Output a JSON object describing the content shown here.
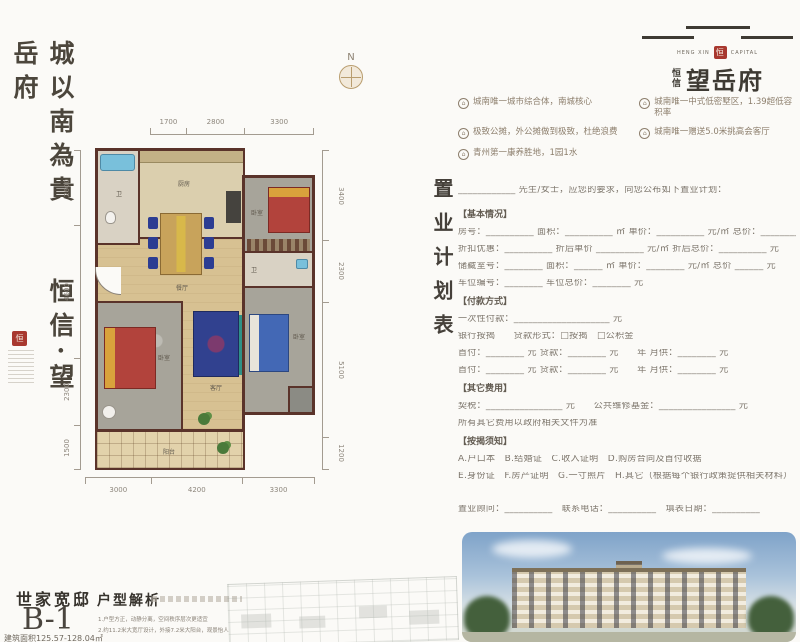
{
  "brand": {
    "calligraphy": "城以南為貴　　恒信·望岳府",
    "seal_char": "恒",
    "logo_en_left": "HENG XIN",
    "logo_en_right": "CAPITAL",
    "logo_small": "恒信",
    "logo_large": "望岳府"
  },
  "selling_points": [
    "城南唯一城市综合体，南城核心",
    "城南唯一中式低密墅区，1.39超低容积率",
    "极致公摊，外公摊做到极致，杜绝浪费",
    "城南唯一赠送5.0米挑高会客厅",
    "青州第一康养胜地，1园1水"
  ],
  "floorplan": {
    "compass_label": "N",
    "dims": {
      "top": [
        1700,
        2800,
        3300
      ],
      "left": [
        2600,
        4600,
        2300,
        1500
      ],
      "right": [
        3400,
        2300,
        5100,
        1200
      ],
      "bottom": [
        3000,
        4200,
        3300
      ]
    },
    "rooms": {
      "bath1": "卫",
      "kitchen": "厨房",
      "bedroom1": "卧室",
      "dining": "餐厅",
      "bath2": "卫",
      "living": "客厅",
      "bedroom2": "卧室",
      "bedroom3": "卧室",
      "balcony": "阳台"
    }
  },
  "form": {
    "title": "置业计划表",
    "intro": "____________ 先生/女士，应您的要求，向您公布如下置业计划：",
    "sections": {
      "basic": {
        "heading": "【基本情况】",
        "rows": [
          "房号：__________ 面积：__________ ㎡ 单价：__________ 元/㎡ 总价：__________ 元",
          "折扣优惠：__________ 折后单价 __________ 元/㎡ 折后总价：__________ 元",
          "储藏室号：________ 面积：______ ㎡ 单价：________ 元/㎡ 总价 ______ 元",
          "车位编号：________ 车位总价：________ 元"
        ]
      },
      "payment": {
        "heading": "【付款方式】",
        "rows": [
          "一次性付款：____________________ 元",
          "银行按揭　　贷款形式：□按揭　□公积金",
          "首付：________ 元 贷款：________ 元　　年 月供：________ 元",
          "首付：________ 元 贷款：________ 元　　年 月供：________ 元"
        ]
      },
      "other": {
        "heading": "【其它费用】",
        "rows": [
          "契税：________________ 元　　公共维修基金：________________ 元",
          "所有其它费用以政府相关文件为准"
        ]
      },
      "notes": {
        "heading": "【按揭须知】",
        "rows": [
          "A.户口本　B.结婚证　C.收入证明　D.购房合同及首付收据",
          "E.身份证　F.房产证明　G.一寸照片　H.其它（根据每个银行政策提供相关材料）"
        ]
      }
    },
    "footer_row": "置业顾问：__________　联系电话：__________　填表日期：__________"
  },
  "unit": {
    "series_name": "世家宽邸",
    "unit_code": "B-1",
    "area_range": "建筑面积125.57-128.04㎡",
    "analysis_title": "户型解析",
    "analysis_lines": [
      "1.户型方正，动静分离，空间秩序层次更适宜",
      "2.约11.2米大宽厅设计，外接7.2米大阳台，观景怡人"
    ]
  }
}
